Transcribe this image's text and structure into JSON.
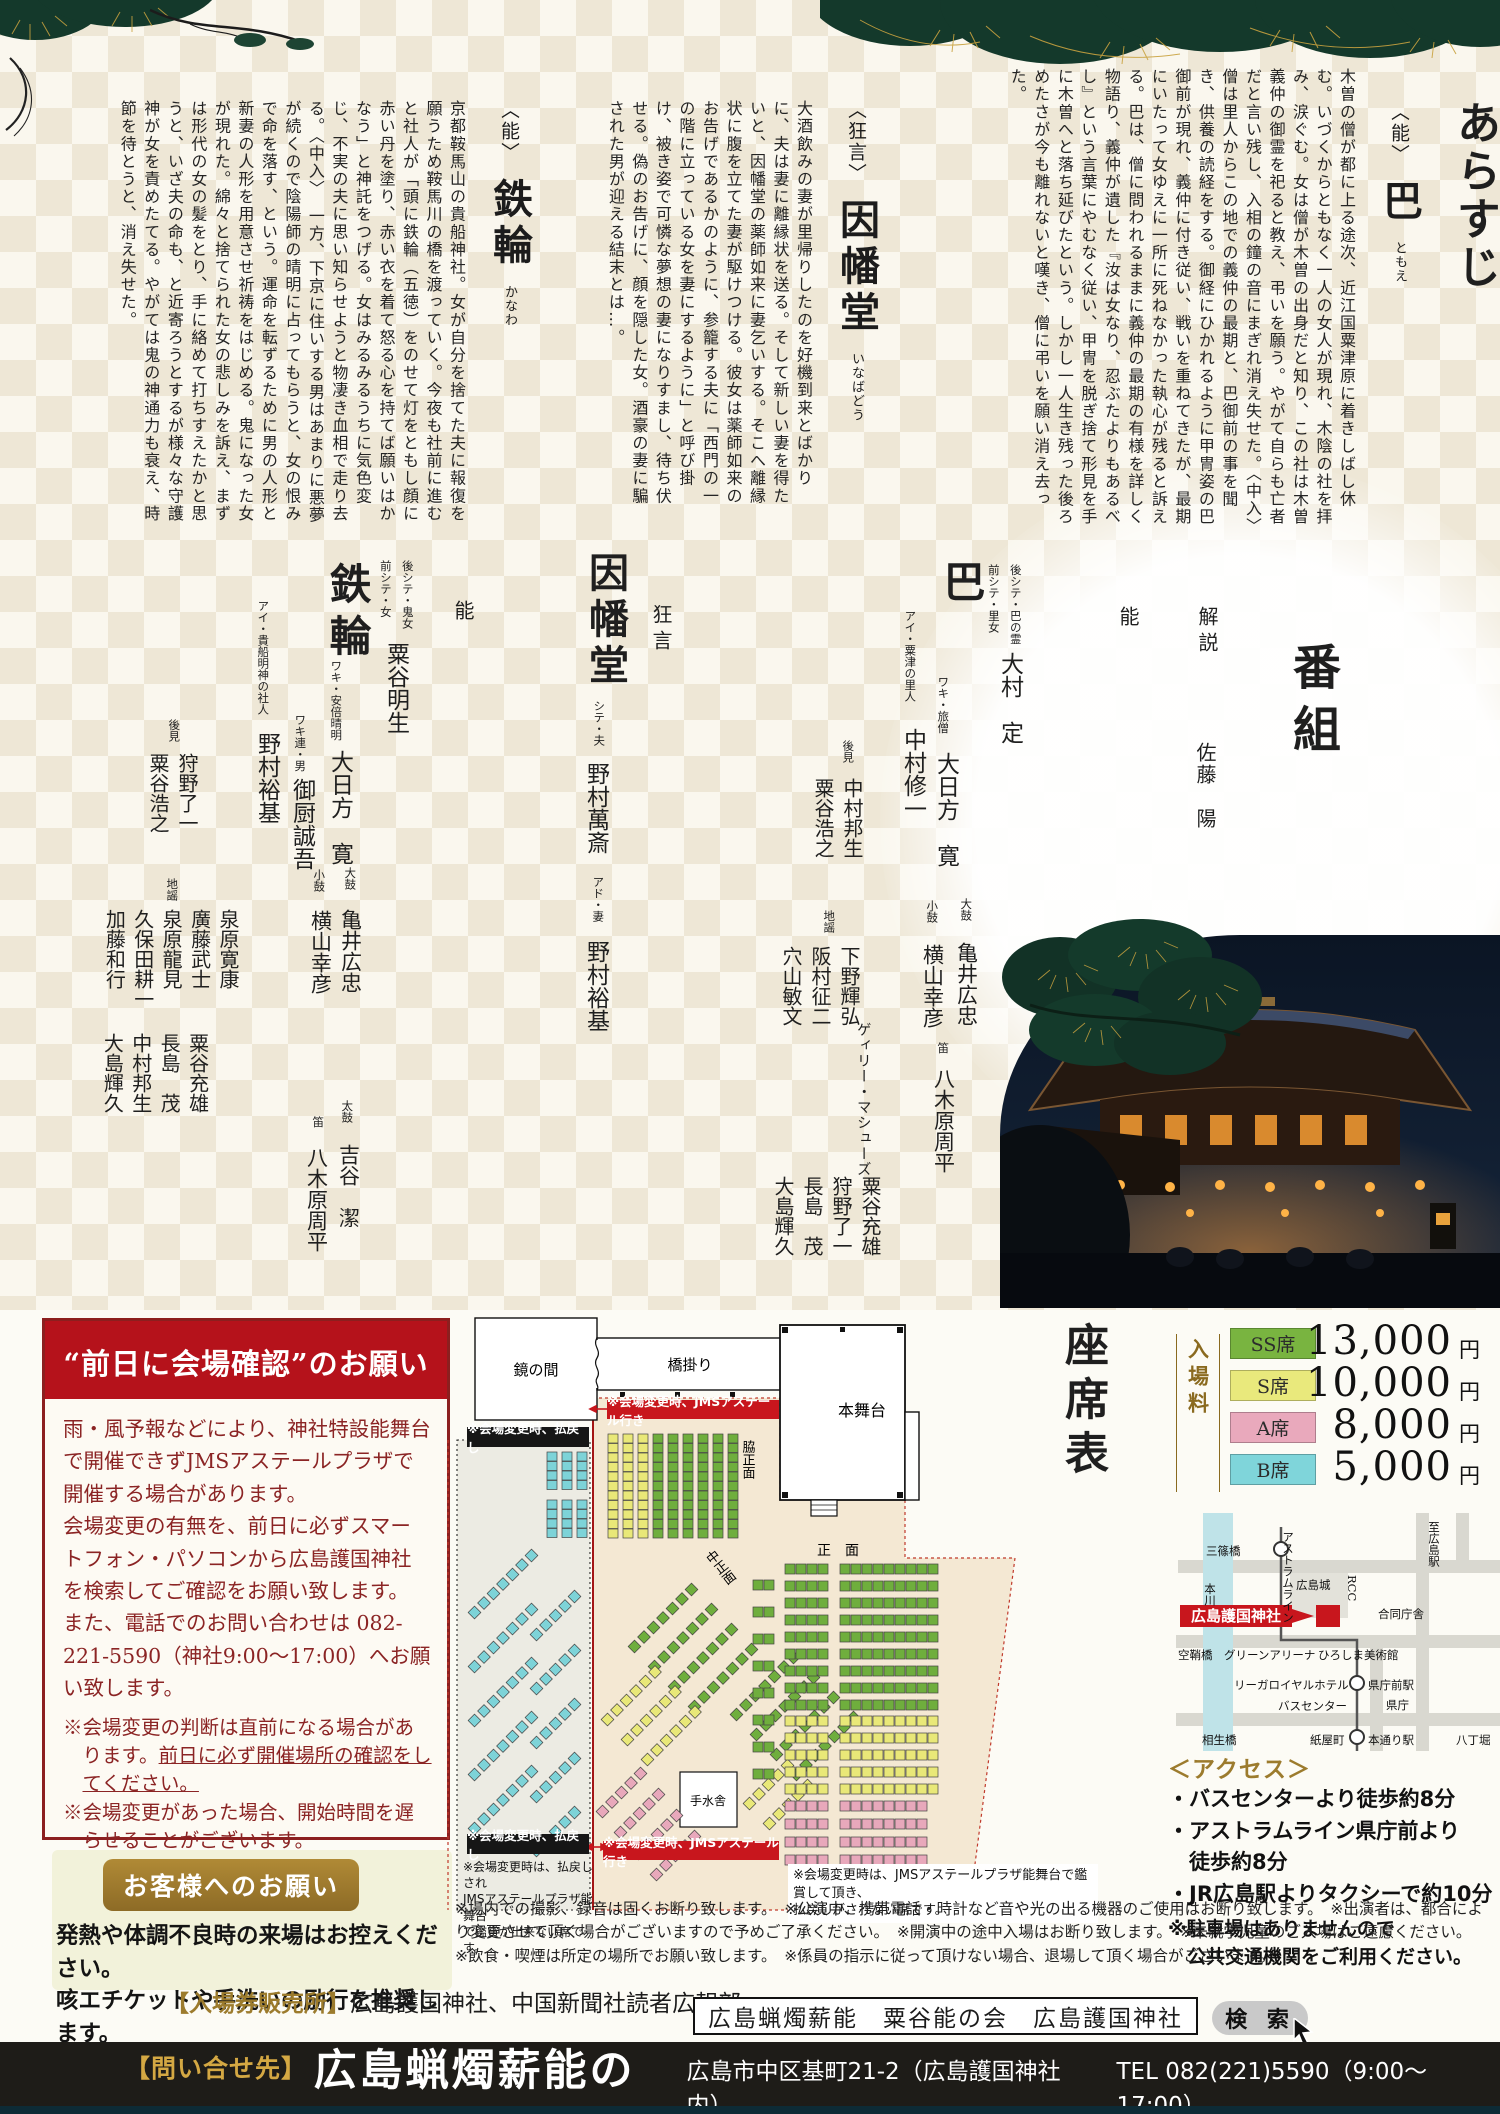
{
  "colors": {
    "accent_red": "#b5121b",
    "gold": "#9c7b2d",
    "pine_green": "#14392b",
    "bar_black": "#1e1c18",
    "seat_ss": "#79b440",
    "seat_s": "#e9e97c",
    "seat_a": "#e9a9bc",
    "seat_b": "#7fd5da"
  },
  "synopsis": {
    "title": "あらすじ",
    "tomoe": {
      "genre": "〈能〉",
      "title": "巴",
      "reading": "ともえ",
      "body": "木曽の僧が都に上る途次、近江国粟津原に着きしばし休む。いづくからともなく一人の女人が現れ、木陰の社を拝み、涙ぐむ。女は僧が木曽の出身だと知り、この社は木曽義仲の御霊を祀ると教え、弔いを願う。やがて自らも亡者だと言い残し、入相の鐘の音にまぎれ消え失せた。〈中入〉　僧は里人からこの地での義仲の最期と、巴御前の事を聞き、供養の読経をする。御経にひかれるように甲冑姿の巴御前が現れ、義仲に付き従い、戦いを重ねてきたが、最期にいたって女ゆえに一所に死ねなかった執心が残ると訴える。巴は、僧に問われるままに義仲の最期の有様を詳しく物語り、義仲が遺した『汝は女なり、忍ぶたよりもあるべし』という言葉にやむなく従い、甲冑を脱ぎ捨て形見を手に木曽へと落ち延びたという。しかし一人生き残った後ろめたさが今も離れないと嘆き、僧に弔いを願い消え去った。"
    },
    "inabado": {
      "genre": "〈狂言〉",
      "title": "因幡堂",
      "reading": "いなばどう",
      "body": "大酒飲みの妻が里帰りしたのを好機到来とばかりに、夫は妻に離縁状を送る。そして新しい妻を得たいと、因幡堂の薬師如来に妻乞いする。そこへ離縁状に腹を立てた妻が駆けつける。彼女は薬師如来のお告げであるかのように、参籠する夫に「西門の一の階に立っている女を妻にするように」と呼び掛け、被き姿で可憐な夢想の妻になりすまし、待ち伏せる。偽のお告げに、顔を隠した女。酒豪の妻に騙された男が迎える結末とは…。"
    },
    "kanawa": {
      "genre": "〈能〉",
      "title": "鉄輪",
      "reading": "かなわ",
      "body": "京都鞍馬山の貴船神社。女が自分を捨てた夫に報復を願うため鞍馬川の橋を渡っていく。今夜も社前に進むと社人が「頭に鉄輪（五徳）をのせて灯をともし顔に赤い丹を塗り、赤い衣を着て怒る心を持てば願いはかなう」と神託をつげる。女はみるみるうちに気色変じ、不実の夫に思い知らせようと物凄き血相で走り去る。〈中入〉　一方、下京に住いする男はあまりに悪夢が続くので陰陽師の晴明に占ってもらうと、女の恨みで命を落す、という。運命を転ずるために男の人形と新妻の人形を用意させ祈祷をはじめる。鬼になった女が現れた。綿々と捨てられた女の悲しみを訴え、まずは形代の女の髪をとり、手に絡めて打ちすえたかと思うと、いざ夫の命も、と近寄ろうとするが様々な守護神が女を責めたてる。やがては鬼の神通力も衰え、時節を待とうと、消え失せた。"
    }
  },
  "program": {
    "title": "番組",
    "commentary_label": "解説",
    "commentary_name": "佐藤　陽",
    "noh1_label": "能",
    "kyogen_label": "狂言",
    "noh2_label": "能",
    "tomoe": {
      "heading": "巴",
      "shite_roles": "後シテ・巴の霊\n前シテ・里女",
      "shite": "大村　定",
      "waki_role": "ワキ・旅僧",
      "waki": "大日方　寛",
      "ai_role": "アイ・粟津の里人",
      "ai": "中村修一",
      "koken_label": "後見",
      "koken": "中村邦生\n粟谷浩之",
      "otsu_label": "大鼓",
      "otsu": "亀井広忠",
      "kotsu_label": "小鼓",
      "kotsu": "横山幸彦",
      "fue_label": "笛",
      "fue": "八木原周平",
      "ji_label": "地謡",
      "ji1": "下野輝弘\n阪村征二\n穴山敏文",
      "ji2": "ゲィリー・マシューズ",
      "ji3": "粟谷充雄\n狩野了一\n長島　茂\n大島輝久"
    },
    "inabado": {
      "heading": "因幡堂",
      "r1": "シテ・夫",
      "n1": "野村萬斎",
      "r2": "アド・妻",
      "n2": "野村裕基"
    },
    "kanawa": {
      "heading": "鉄輪",
      "shite_roles": "後シテ・鬼女\n前シテ・女",
      "shite": "粟谷明生",
      "waki_role": "ワキ・安倍晴明",
      "waki": "大日方　寛",
      "wakitsure_role": "ワキ連・男",
      "wakitsure": "御厨誠吾",
      "ai_role": "アイ・貴船明神の社人",
      "ai": "野村裕基",
      "otsu_label": "大鼓",
      "otsu": "亀井広忠",
      "kotsu_label": "小鼓",
      "kotsu": "横山幸彦",
      "taiko_label": "太鼓",
      "taiko": "吉谷　潔",
      "fue_label": "笛",
      "fue": "八木原周平",
      "koken_label": "後見",
      "koken": "狩野了一\n粟谷浩之",
      "ji_label": "地謡",
      "ji1": "泉原寛康\n廣藤武士\n泉原龍見\n久保田耕一\n加藤和行",
      "ji2": "粟谷充雄\n長島　茂\n中村邦生\n大島輝久"
    }
  },
  "warning": {
    "title": "“前日に会場確認”のお願い",
    "p1": "雨・風予報などにより、神社特設能舞台で開催できずJMSアステールプラザで開催する場合があります。",
    "p2": "会場変更の有無を、前日に必ずスマートフォン・パソコンから広島護国神社を検索してご確認をお願い致します。",
    "p3": "また、電話でのお問い合わせは 082-221-5590（神社9:00～17:00）へお願い致します。",
    "n1a": "※会場変更の判断は直前になる場合があります。",
    "n1b": "前日に必ず開催場所の確認をしてください。",
    "n2": "※会場変更があった場合、開始時間を遅らせることがございます。",
    "n3": "※天候不良時の払い戻しチケットの対応は、神社でのみ行います。"
  },
  "customer": {
    "badge": "お客様へのお願い",
    "l1": "発熱や体調不良時の来場はお控えください。",
    "l2": "咳エチケットや手洗いの励行を推奨します。"
  },
  "tickets": {
    "label": "【入場券販売所】",
    "value": "広島護国神社、中国新聞社読者広報部"
  },
  "search": {
    "query": "広島蝋燭薪能　粟谷能の会　広島護国神社",
    "button": "検 索"
  },
  "contact": {
    "label": "【問い合せ先】",
    "org": "広島蝋燭薪能の会",
    "addr": "広島市中区基町21-2（広島護国神社 内）",
    "tel": "TEL 082(221)5590（9:00～17:00）"
  },
  "notes_bottom": {
    "p1": "※場内での撮影、録音は固くお断り致します。　※公演中、携帯電話・時計など音や光の出る機器のご使用はお断り致します。　※出演者は、都合により変更させて頂く場合がございますので予めご了承ください。　※開演中の途中入場はお断り致します。　※未就学児童のご入場はご遠慮ください。",
    "p2": "※飲食・喫煙は所定の場所でお願い致します。　※係員の指示に従って頂けない場合、退場して頂く場合がございます。"
  },
  "access": {
    "title": "＜アクセス＞",
    "i1": "・バスセンターより徒歩約8分",
    "i2a": "・アストラムライン県庁前より",
    "i2b": "　徒歩約8分",
    "i3": "・JR広島駅よりタクシーで約10分",
    "n1": "※駐車場はありませんので",
    "n2": "　公共交通機関をご利用ください。"
  },
  "seatmap": {
    "title": "座席表",
    "fee_label": "入場料",
    "prices": [
      {
        "label": "SS席",
        "value": "13,000",
        "unit": "円",
        "color": "#79b440"
      },
      {
        "label": "S席",
        "value": "10,000",
        "unit": "円",
        "color": "#e9e97c"
      },
      {
        "label": "A席",
        "value": "8,000",
        "unit": "円",
        "color": "#e9a9bc"
      },
      {
        "label": "B席",
        "value": "5,000",
        "unit": "円",
        "color": "#7fd5da"
      }
    ],
    "labels": {
      "mirror": "鏡の間",
      "bridge": "橋掛り",
      "stage": "本舞台",
      "waki": "脇正面",
      "naka": "中正面",
      "front": "正　面",
      "chozu": "手水舎"
    },
    "red_label": "※会場変更時、JMSアステール行き",
    "black_label": "※会場変更時、払戻し",
    "note_left": "※会場変更時は、払戻しされ\nJMSアステールプラザ能舞台\nで鑑賞が出来ない席です。",
    "note_right": "※会場変更時は、JMSアステールプラザ能舞台で鑑賞して頂き、\n払戻しがされない席です。"
  },
  "map": {
    "m1": "三篠橋",
    "m2": "至広島駅",
    "m3": "本川",
    "m4": "アストラムライン",
    "m5": "広島城",
    "m6": "RCC",
    "m7": "広島護国神社",
    "m8": "合同庁舎",
    "m9": "空鞘橋",
    "m10": "グリーンアリーナ",
    "m11": "ひろしま美術館",
    "m12": "リーガロイヤルホテル",
    "m13": "県庁前駅",
    "m14": "県庁",
    "m15": "バスセンター",
    "m16": "相生橋",
    "m17": "紙屋町",
    "m18": "本通り駅",
    "m19": "八丁堀"
  }
}
